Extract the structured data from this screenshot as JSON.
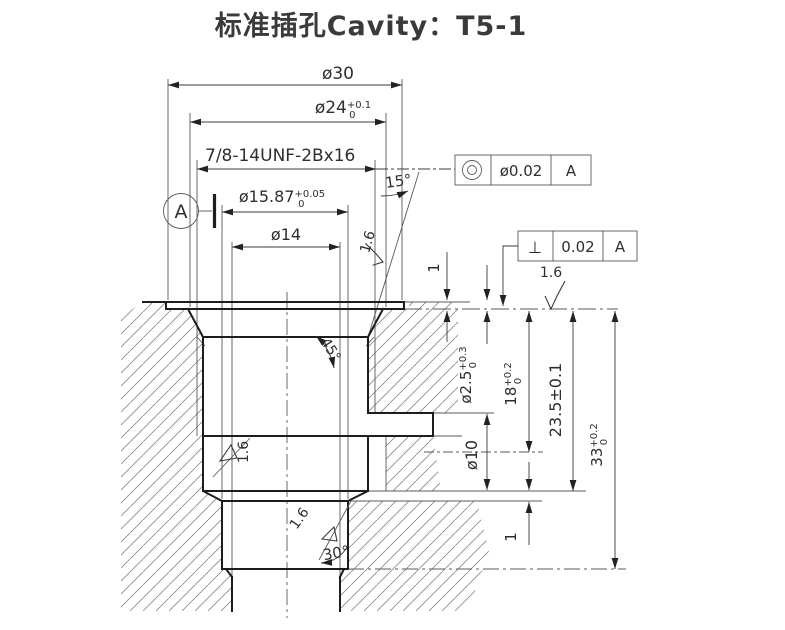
{
  "title": "标准插孔Cavity：T5-1",
  "dimensions": {
    "outer_recess_dia": {
      "base": "ø30"
    },
    "counterbore_dia": {
      "base": "ø24",
      "tol_upper": "+0.1",
      "tol_lower": "0"
    },
    "thread_spec": {
      "label": "7/8-14UNF-2Bx16"
    },
    "pilot_dia": {
      "base": "ø15.87",
      "tol_upper": "+0.05",
      "tol_lower": "0"
    },
    "bottom_dia": {
      "base": "ø14"
    },
    "taper_angle": {
      "label": "15°"
    },
    "chamfer_angle": {
      "label": "45°"
    },
    "bottom_chamfer_angle": {
      "label": "30°"
    },
    "recess_depth": {
      "label": "1"
    },
    "vent_dia": {
      "base": "ø2.5",
      "tol_upper": "+0.3",
      "tol_lower": "0"
    },
    "thread_depth": {
      "base": "18",
      "tol_upper": "+0.2",
      "tol_lower": "0"
    },
    "mid_depth": {
      "label": "23.5±0.1"
    },
    "total_depth": {
      "base": "33",
      "tol_upper": "+0.2",
      "tol_lower": "0"
    },
    "side_hole_dia": {
      "label": "ø10"
    },
    "step_height": {
      "label": "1"
    }
  },
  "surface_roughness": {
    "value": "1.6"
  },
  "datum": {
    "label": "A"
  },
  "gdt_frames": [
    {
      "symbol": "concentricity",
      "tolerance": "ø0.02",
      "datum": "A"
    },
    {
      "symbol": "⊥",
      "tolerance": "0.02",
      "datum": "A"
    }
  ]
}
